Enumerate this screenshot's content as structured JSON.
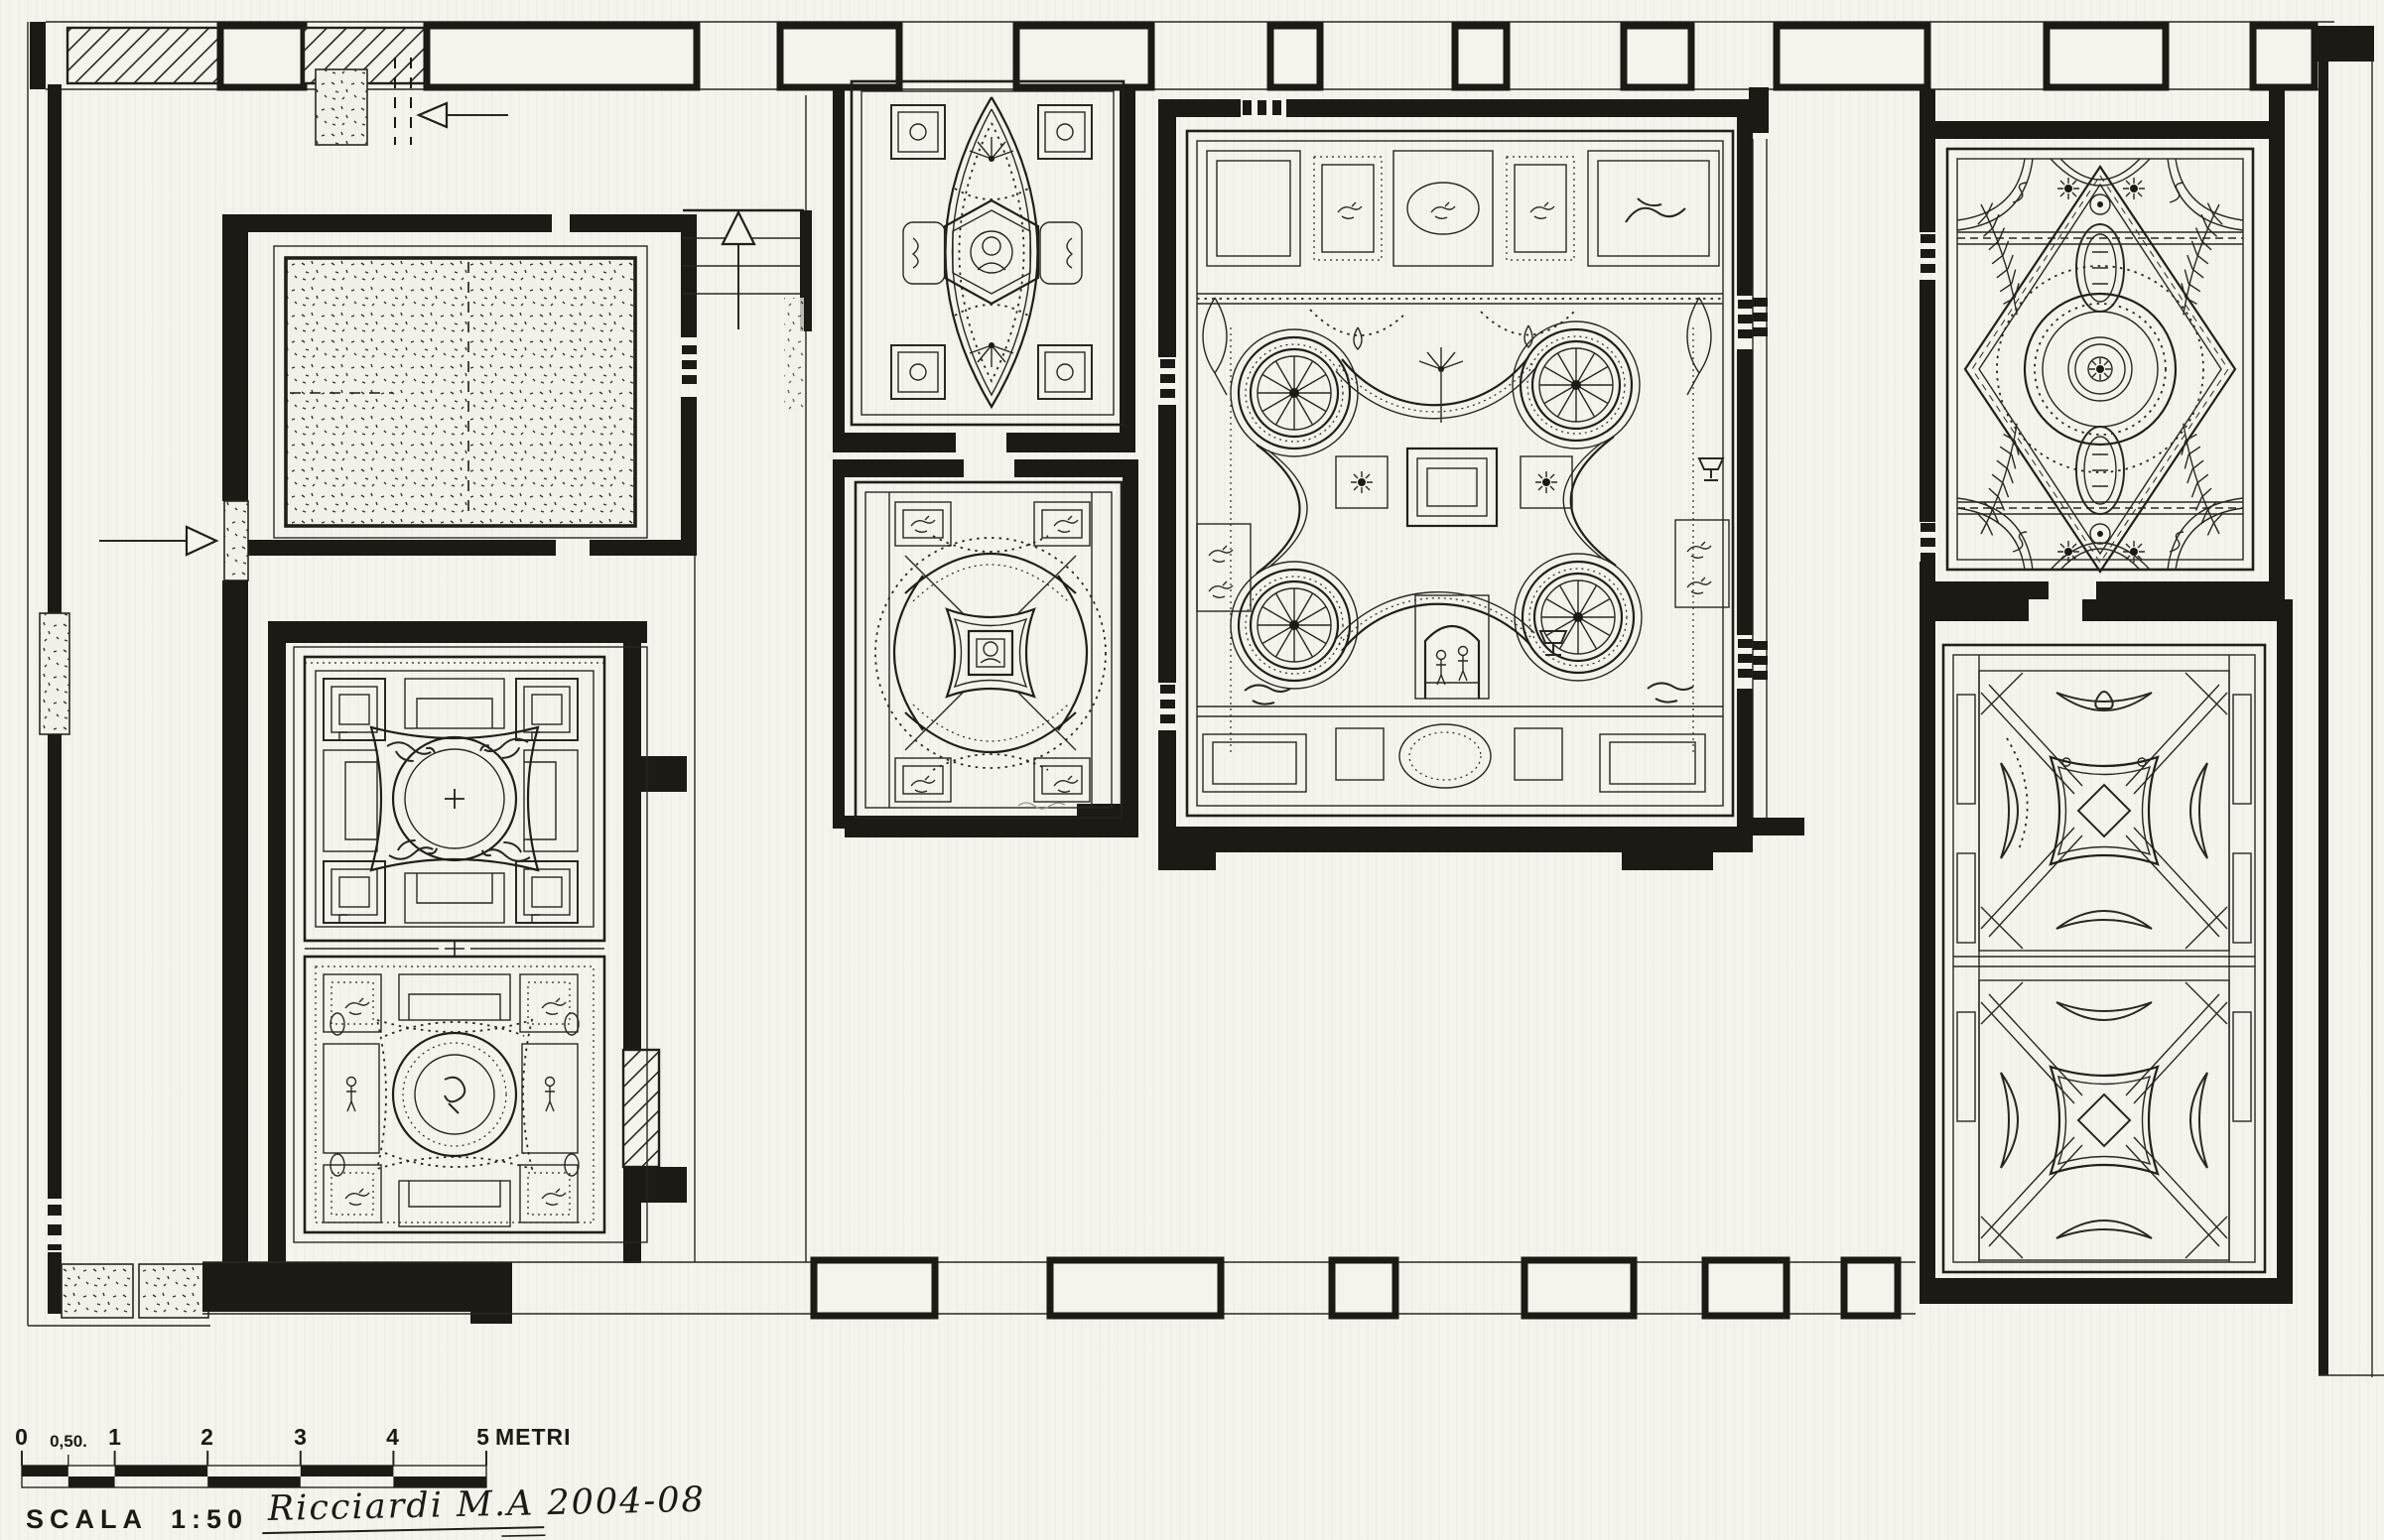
{
  "sheet": {
    "paper_color": "#f5f3ec",
    "ink_color": "#1d1a16"
  },
  "scale_bar": {
    "tick_labels": [
      "0",
      "0,50.",
      "1",
      "2",
      "3",
      "4",
      "5"
    ],
    "unit_label": "METRI",
    "scale_word": "SCALA",
    "scale_ratio": "1:50",
    "signature": "Ricciardi M.A 2004-08"
  }
}
